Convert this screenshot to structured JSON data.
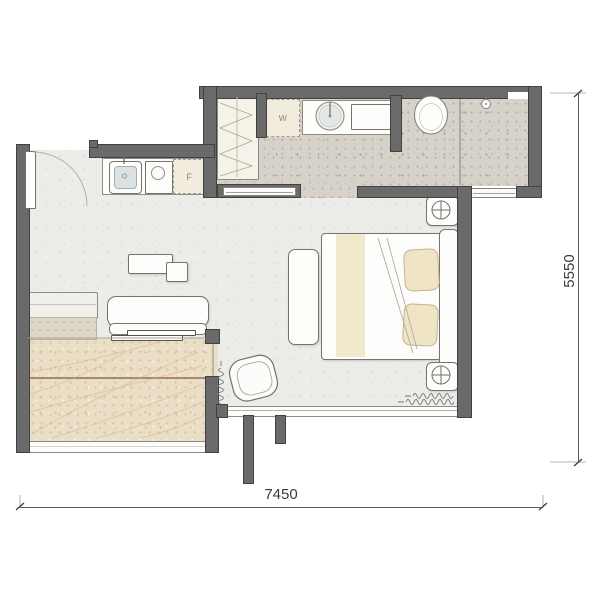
{
  "plan": {
    "kind": "apartment floor plan",
    "appliance_labels": {
      "washer": "W",
      "fridge": "F"
    },
    "dimensions": {
      "width_mm": "7450",
      "depth_mm": "5550"
    },
    "fixtures": [
      "entry-door",
      "kitchen-counter",
      "kitchen-sink",
      "hob",
      "fridge",
      "wardrobe",
      "washing-machine",
      "vanity-basin",
      "mirror-cabinet",
      "toilet",
      "shower-head",
      "shower-glass",
      "sliding-doors",
      "bed",
      "pillows",
      "duvet-fold",
      "headboard",
      "nightstands",
      "table-lamps",
      "bench",
      "sofa",
      "coffee-table",
      "lounge-chair",
      "sideboard",
      "balcony-deck",
      "curtains",
      "window",
      "wall-fins",
      "dimension-lines"
    ],
    "colors": {
      "wall": "#6a6a6a",
      "wall_edge": "#2d2d2d",
      "floor_main": "#ecece9",
      "floor_bath": "#d6d1c9",
      "floor_balcony": "#eadfc6",
      "deck_accent_line": "#9c6a50",
      "pillow": "#efe5c6",
      "dimension_text": "#3c3c3c"
    }
  }
}
